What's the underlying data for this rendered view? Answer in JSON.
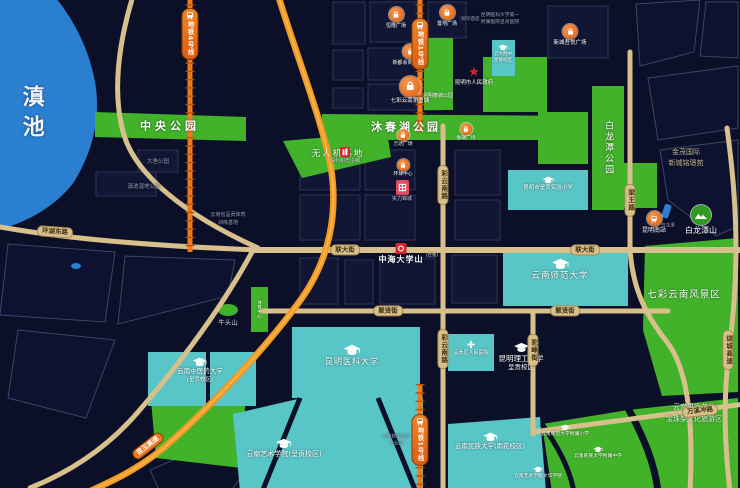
{
  "colors": {
    "background": "#0b1028",
    "lake_blue": "#2b7fd0",
    "park_green": "#41b22a",
    "campus_cyan": "#58c5c7",
    "road_beige": "#d8c08c",
    "highway_orange": "#f29a22",
    "metro_orange": "#ee7a1d",
    "marker_red": "#d8242e"
  },
  "lake": {
    "label": "滇池"
  },
  "parks": {
    "central": "中央公园",
    "muchunhu": "沐春湖公园",
    "uav_base": "无人机基地",
    "bailongtan": "白龙潭公园",
    "qicai_scenic": "七彩云南风景区",
    "chuncheng": "昆明春城公园"
  },
  "nature": {
    "bailongtan_hill": "白龙潭山",
    "bailongtan_pond": "白龙潭",
    "niutou_hill": "牛头山",
    "wetland": "滇池湿地公园",
    "dayu_park": "大渔公园",
    "guoyi_line1": "云南果逸花谷",
    "guoyi_line2": "宝珠梨文化旅游区"
  },
  "government": {
    "city_hall": "昆明市人民政府"
  },
  "metro": {
    "line4": "地铁4号线",
    "line1_north": "地铁1号线",
    "line1_south": "地铁1号线"
  },
  "roads": {
    "lianda": "联大街",
    "juxian": "聚贤街",
    "caiyunnan": "彩云南路",
    "liangwang": "梁王路",
    "tuofeng": "驼峰街",
    "huanhudong": "环湖东路",
    "raocheng": "绕城高速",
    "wanxichong": "万溪冲路",
    "kunyu": "昆玉高速"
  },
  "rail": {
    "south_station": "昆明南站"
  },
  "malls": [
    "恒隆广场",
    "置地广场",
    "新都会商业中心",
    "七彩云南第壹城",
    "万达广场",
    "环球中心",
    "春融广场",
    "新城吾悦广场"
  ],
  "projects": {
    "featured": "中海大学山",
    "featured_note": "(在售)",
    "marker1": "保利和光尘樾",
    "marker2": "实力锦城"
  },
  "education": {
    "yunnan_normal": "云南师范大学",
    "kunming_medical": "昆明医科大学",
    "tcm_line1": "云南中医药大学",
    "tcm_line2": "(呈贡校区)",
    "kust_line1": "昆明理工大学",
    "kust_line2": "呈贡校区",
    "arts": "云南艺术学院(呈贡校区)",
    "minzu": "云南民族大学(雨花校区)",
    "yda_line1": "云大附中",
    "yda_line2": "星耀校区",
    "shiyan_primary": "昆明市呈贡实验小学",
    "normal_primary": "云南师范大学附属小学",
    "minzu_middle": "云南民族大学附属中学",
    "arts_wenhua": "云南艺术学院文华学院"
  },
  "medical": {
    "renmin": "呈贡区人民医院",
    "kmu_line1": "昆明医科大学第一",
    "kmu_line2": "附属医院呈贡医院"
  },
  "places": {
    "hotel": "洲际酒店",
    "jinmao_line1": "金茂国际",
    "jinmao_line2": "新城铭璟苑",
    "industry_line1": "云南数字经济",
    "industry_line2": "产业园",
    "sports_line1": "云南省呈贡体育",
    "sports_line2": "训练基地",
    "sports_center": "体育中心"
  }
}
